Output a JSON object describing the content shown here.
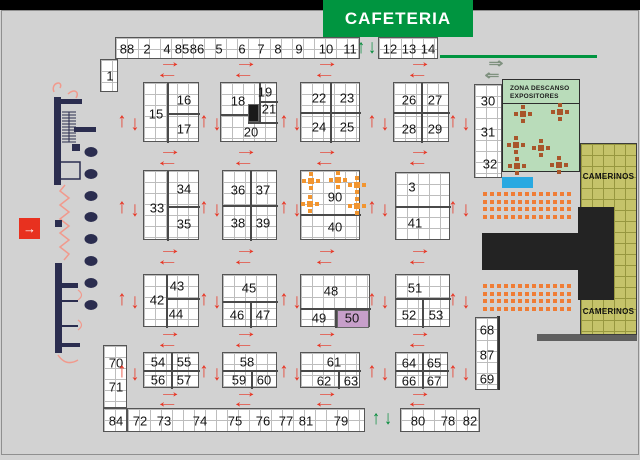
{
  "banner": {
    "cafeteria": "CAFETERIA"
  },
  "zona_descanso": {
    "line1": "ZONA DESCANSO",
    "line2": "EXPOSITORES",
    "tables": [
      {
        "x": 20,
        "y": 34
      },
      {
        "x": 57,
        "y": 32
      },
      {
        "x": 13,
        "y": 65
      },
      {
        "x": 38,
        "y": 68
      },
      {
        "x": 14,
        "y": 86
      },
      {
        "x": 56,
        "y": 85
      }
    ]
  },
  "camerinos": {
    "top": "CAMERINOS",
    "bottom": "CAMERINOS"
  },
  "entrance": {
    "glyph": "→"
  },
  "colors": {
    "bg": "#d2d2d2",
    "red_arrow": "#e8311f",
    "green_arrow": "#008a38",
    "cafeteria_green": "#009540",
    "zona_green": "#b9dcba",
    "table_brown": "#a8562b",
    "table_orange": "#f2952f",
    "seat_orange": "#f07d35",
    "olive": "#c5c36a",
    "olive_line": "#97973f",
    "purple_booth": "#c79fca",
    "navy": "#2b2d4f",
    "salmon": "#f19a8d",
    "pool_blue": "#29a9e1",
    "stage_black": "#232323"
  },
  "strips": [
    {
      "name": "top-main",
      "x": 115,
      "y": 37,
      "w": 245,
      "h": 22,
      "labels": [
        {
          "t": "88",
          "cx": 11
        },
        {
          "t": "2",
          "cx": 31
        },
        {
          "t": "4",
          "cx": 51
        },
        {
          "t": "85",
          "cx": 66
        },
        {
          "t": "86",
          "cx": 81
        },
        {
          "t": "5",
          "cx": 103
        },
        {
          "t": "6",
          "cx": 126
        },
        {
          "t": "7",
          "cx": 145
        },
        {
          "t": "8",
          "cx": 162
        },
        {
          "t": "9",
          "cx": 183
        },
        {
          "t": "10",
          "cx": 210
        },
        {
          "t": "11",
          "cx": 234
        }
      ]
    },
    {
      "name": "top-right",
      "x": 378,
      "y": 37,
      "w": 60,
      "h": 22,
      "labels": [
        {
          "t": "12",
          "cx": 11
        },
        {
          "t": "13",
          "cx": 30
        },
        {
          "t": "14",
          "cx": 49
        }
      ]
    },
    {
      "name": "booth-1",
      "x": 100,
      "y": 59,
      "w": 18,
      "h": 33,
      "labels": [
        {
          "t": "1",
          "cx": 9,
          "cy": 16
        }
      ]
    },
    {
      "name": "right-30",
      "x": 474,
      "y": 84,
      "w": 28,
      "h": 94,
      "labels": [
        {
          "t": "30",
          "cx": 13,
          "cy": 16
        },
        {
          "t": "31",
          "cx": 13,
          "cy": 47
        },
        {
          "t": "32",
          "cx": 15,
          "cy": 79
        }
      ]
    },
    {
      "name": "right-68",
      "x": 475,
      "y": 317,
      "w": 23,
      "h": 73,
      "labels": [
        {
          "t": "68",
          "cx": 11,
          "cy": 12
        },
        {
          "t": "87",
          "cx": 11,
          "cy": 37
        },
        {
          "t": "69",
          "cx": 11,
          "cy": 61
        }
      ]
    },
    {
      "name": "left-70",
      "x": 103,
      "y": 345,
      "w": 24,
      "h": 63,
      "labels": [
        {
          "t": "70",
          "cx": 12,
          "cy": 17
        },
        {
          "t": "71",
          "cx": 12,
          "cy": 41
        }
      ]
    },
    {
      "name": "corner-84",
      "x": 103,
      "y": 408,
      "w": 24,
      "h": 24,
      "labels": [
        {
          "t": "84",
          "cx": 12,
          "cy": 12
        }
      ]
    },
    {
      "name": "bottom-left",
      "x": 127,
      "y": 408,
      "w": 238,
      "h": 24,
      "labels": [
        {
          "t": "72",
          "cx": 12
        },
        {
          "t": "73",
          "cx": 36
        },
        {
          "t": "74",
          "cx": 72
        },
        {
          "t": "75",
          "cx": 107
        },
        {
          "t": "76",
          "cx": 135
        },
        {
          "t": "77",
          "cx": 158
        },
        {
          "t": "81",
          "cx": 178
        },
        {
          "t": "79",
          "cx": 213
        }
      ]
    },
    {
      "name": "bottom-right",
      "x": 400,
      "y": 408,
      "w": 80,
      "h": 24,
      "labels": [
        {
          "t": "80",
          "cx": 17
        },
        {
          "t": "78",
          "cx": 47
        },
        {
          "t": "82",
          "cx": 69
        }
      ]
    }
  ],
  "blocks": [
    {
      "name": "block-15",
      "x": 143,
      "y": 82,
      "w": 56,
      "h": 60,
      "labels": [
        {
          "t": "15",
          "cx": 12,
          "cy": 31
        },
        {
          "t": "16",
          "cx": 40,
          "cy": 17
        },
        {
          "t": "17",
          "cx": 40,
          "cy": 46
        }
      ],
      "dividers": [
        {
          "x": 23,
          "y": 0,
          "w": 2,
          "h": 60
        },
        {
          "x": 23,
          "y": 30,
          "w": 33,
          "h": 2
        }
      ]
    },
    {
      "name": "block-18",
      "x": 220,
      "y": 82,
      "w": 57,
      "h": 60,
      "labels": [
        {
          "t": "18",
          "cx": 17,
          "cy": 18
        },
        {
          "t": "19",
          "cx": 44,
          "cy": 9
        },
        {
          "t": "21",
          "cx": 48,
          "cy": 26
        },
        {
          "t": "20",
          "cx": 30,
          "cy": 49
        }
      ],
      "dividers": [
        {
          "x": 0,
          "y": 31,
          "w": 27,
          "h": 2
        },
        {
          "x": 38,
          "y": 0,
          "w": 2,
          "h": 40
        },
        {
          "x": 38,
          "y": 18,
          "w": 19,
          "h": 2
        },
        {
          "x": 27,
          "y": 39,
          "w": 30,
          "h": 2
        }
      ],
      "cells": [
        {
          "x": 27,
          "y": 21,
          "w": 11,
          "h": 18,
          "color": "#1a1a1a"
        }
      ]
    },
    {
      "name": "block-22",
      "x": 300,
      "y": 82,
      "w": 60,
      "h": 60,
      "labels": [
        {
          "t": "22",
          "cx": 18,
          "cy": 15
        },
        {
          "t": "23",
          "cx": 46,
          "cy": 15
        },
        {
          "t": "24",
          "cx": 18,
          "cy": 44
        },
        {
          "t": "25",
          "cx": 46,
          "cy": 44
        }
      ],
      "dividers": [
        {
          "x": 29,
          "y": 0,
          "w": 2,
          "h": 60
        },
        {
          "x": 0,
          "y": 29,
          "w": 60,
          "h": 2
        }
      ]
    },
    {
      "name": "block-26",
      "x": 393,
      "y": 82,
      "w": 56,
      "h": 60,
      "labels": [
        {
          "t": "26",
          "cx": 15,
          "cy": 17
        },
        {
          "t": "27",
          "cx": 41,
          "cy": 17
        },
        {
          "t": "28",
          "cx": 15,
          "cy": 46
        },
        {
          "t": "29",
          "cx": 41,
          "cy": 46
        }
      ],
      "dividers": [
        {
          "x": 27,
          "y": 0,
          "w": 2,
          "h": 60
        },
        {
          "x": 0,
          "y": 29,
          "w": 56,
          "h": 2
        }
      ]
    },
    {
      "name": "block-33",
      "x": 143,
      "y": 170,
      "w": 56,
      "h": 70,
      "labels": [
        {
          "t": "33",
          "cx": 13,
          "cy": 37
        },
        {
          "t": "34",
          "cx": 40,
          "cy": 18
        },
        {
          "t": "35",
          "cx": 40,
          "cy": 53
        }
      ],
      "dividers": [
        {
          "x": 23,
          "y": 0,
          "w": 2,
          "h": 70
        },
        {
          "x": 23,
          "y": 35,
          "w": 33,
          "h": 2
        }
      ]
    },
    {
      "name": "block-36",
      "x": 222,
      "y": 170,
      "w": 55,
      "h": 70,
      "labels": [
        {
          "t": "36",
          "cx": 15,
          "cy": 19
        },
        {
          "t": "37",
          "cx": 40,
          "cy": 19
        },
        {
          "t": "38",
          "cx": 15,
          "cy": 52
        },
        {
          "t": "39",
          "cx": 40,
          "cy": 52
        }
      ],
      "dividers": [
        {
          "x": 27,
          "y": 0,
          "w": 2,
          "h": 70
        },
        {
          "x": 0,
          "y": 34,
          "w": 55,
          "h": 2
        }
      ]
    },
    {
      "name": "block-90",
      "x": 300,
      "y": 170,
      "w": 60,
      "h": 70,
      "labels": [
        {
          "t": "90",
          "cx": 34,
          "cy": 26
        },
        {
          "t": "40",
          "cx": 34,
          "cy": 56
        }
      ],
      "dividers": [
        {
          "x": 0,
          "y": 43,
          "w": 60,
          "h": 2
        }
      ],
      "tables": [
        {
          "x": 10,
          "y": 10
        },
        {
          "x": 37,
          "y": 9
        },
        {
          "x": 56,
          "y": 14
        },
        {
          "x": 9,
          "y": 33
        },
        {
          "x": 56,
          "y": 35
        }
      ]
    },
    {
      "name": "block-3",
      "x": 395,
      "y": 172,
      "w": 55,
      "h": 68,
      "labels": [
        {
          "t": "3",
          "cx": 16,
          "cy": 14
        },
        {
          "t": "41",
          "cx": 19,
          "cy": 50
        }
      ],
      "dividers": [
        {
          "x": 0,
          "y": 33,
          "w": 55,
          "h": 2
        }
      ]
    },
    {
      "name": "block-42",
      "x": 143,
      "y": 274,
      "w": 56,
      "h": 53,
      "labels": [
        {
          "t": "42",
          "cx": 13,
          "cy": 25
        },
        {
          "t": "43",
          "cx": 33,
          "cy": 11
        },
        {
          "t": "44",
          "cx": 32,
          "cy": 39
        }
      ],
      "dividers": [
        {
          "x": 22,
          "y": 0,
          "w": 2,
          "h": 53
        },
        {
          "x": 22,
          "y": 23,
          "w": 34,
          "h": 2
        }
      ]
    },
    {
      "name": "block-45",
      "x": 222,
      "y": 274,
      "w": 55,
      "h": 53,
      "labels": [
        {
          "t": "45",
          "cx": 26,
          "cy": 13
        },
        {
          "t": "46",
          "cx": 14,
          "cy": 40
        },
        {
          "t": "47",
          "cx": 40,
          "cy": 40
        }
      ],
      "dividers": [
        {
          "x": 0,
          "y": 26,
          "w": 55,
          "h": 2
        },
        {
          "x": 27,
          "y": 26,
          "w": 2,
          "h": 27
        }
      ]
    },
    {
      "name": "block-48",
      "x": 300,
      "y": 274,
      "w": 70,
      "h": 53,
      "labels": [
        {
          "t": "48",
          "cx": 30,
          "cy": 16
        },
        {
          "t": "49",
          "cx": 18,
          "cy": 43
        },
        {
          "t": "50",
          "cx": 51,
          "cy": 43
        }
      ],
      "dividers": [
        {
          "x": 0,
          "y": 33,
          "w": 70,
          "h": 2
        },
        {
          "x": 34,
          "y": 33,
          "w": 2,
          "h": 20
        }
      ],
      "cells": [
        {
          "x": 36,
          "y": 35,
          "w": 32,
          "h": 18,
          "color": "#c79fca"
        }
      ]
    },
    {
      "name": "block-51",
      "x": 395,
      "y": 274,
      "w": 55,
      "h": 53,
      "labels": [
        {
          "t": "51",
          "cx": 19,
          "cy": 13
        },
        {
          "t": "52",
          "cx": 13,
          "cy": 40
        },
        {
          "t": "53",
          "cx": 40,
          "cy": 40
        }
      ],
      "dividers": [
        {
          "x": 0,
          "y": 23,
          "w": 55,
          "h": 2
        },
        {
          "x": 26,
          "y": 23,
          "w": 2,
          "h": 30
        }
      ]
    },
    {
      "name": "block-54",
      "x": 143,
      "y": 352,
      "w": 56,
      "h": 36,
      "labels": [
        {
          "t": "54",
          "cx": 14,
          "cy": 9
        },
        {
          "t": "55",
          "cx": 40,
          "cy": 9
        },
        {
          "t": "56",
          "cx": 14,
          "cy": 27
        },
        {
          "t": "57",
          "cx": 40,
          "cy": 27
        }
      ],
      "dividers": [
        {
          "x": 27,
          "y": 0,
          "w": 2,
          "h": 36
        },
        {
          "x": 0,
          "y": 17,
          "w": 56,
          "h": 2
        }
      ]
    },
    {
      "name": "block-58",
      "x": 222,
      "y": 352,
      "w": 55,
      "h": 36,
      "labels": [
        {
          "t": "58",
          "cx": 24,
          "cy": 9
        },
        {
          "t": "59",
          "cx": 16,
          "cy": 27
        },
        {
          "t": "60",
          "cx": 41,
          "cy": 27
        }
      ],
      "dividers": [
        {
          "x": 0,
          "y": 17,
          "w": 55,
          "h": 2
        },
        {
          "x": 28,
          "y": 17,
          "w": 2,
          "h": 19
        }
      ]
    },
    {
      "name": "block-61",
      "x": 300,
      "y": 352,
      "w": 60,
      "h": 36,
      "labels": [
        {
          "t": "61",
          "cx": 33,
          "cy": 9
        },
        {
          "t": "62",
          "cx": 23,
          "cy": 28
        },
        {
          "t": "63",
          "cx": 50,
          "cy": 28
        }
      ],
      "dividers": [
        {
          "x": 0,
          "y": 17,
          "w": 60,
          "h": 2
        },
        {
          "x": 37,
          "y": 17,
          "w": 2,
          "h": 19
        }
      ]
    },
    {
      "name": "block-64",
      "x": 395,
      "y": 352,
      "w": 53,
      "h": 36,
      "labels": [
        {
          "t": "64",
          "cx": 13,
          "cy": 10
        },
        {
          "t": "65",
          "cx": 38,
          "cy": 10
        },
        {
          "t": "66",
          "cx": 13,
          "cy": 28
        },
        {
          "t": "67",
          "cx": 38,
          "cy": 28
        }
      ],
      "dividers": [
        {
          "x": 26,
          "y": 0,
          "w": 2,
          "h": 36
        },
        {
          "x": 0,
          "y": 17,
          "w": 53,
          "h": 2
        }
      ]
    }
  ],
  "arrows": {
    "icons": {
      "up": "↑",
      "down": "↓",
      "left": "←",
      "right": "→",
      "dright": "⇒",
      "dleft": "⇐"
    },
    "red_vertical": {
      "cols": [
        122,
        204,
        284,
        372,
        453
      ],
      "rows": [
        120,
        206,
        298,
        370
      ]
    },
    "red_horizontal": {
      "cols": [
        170,
        246,
        327,
        420
      ],
      "gaps": [
        {
          "r": 63,
          "l": 74
        },
        {
          "r": 151,
          "l": 162
        },
        {
          "r": 250,
          "l": 261
        },
        {
          "r": 333,
          "l": 344
        },
        {
          "r": 393,
          "l": 403
        }
      ]
    },
    "green": [
      {
        "g": "up",
        "x": 361,
        "y": 48
      },
      {
        "g": "down",
        "x": 372,
        "y": 48
      },
      {
        "g": "up",
        "x": 376,
        "y": 419
      },
      {
        "g": "down",
        "x": 388,
        "y": 419
      }
    ],
    "gray": [
      {
        "g": "dright",
        "x": 496,
        "y": 63
      },
      {
        "g": "dleft",
        "x": 492,
        "y": 75
      }
    ]
  },
  "seating": {
    "blocks": [
      {
        "x": 483,
        "y": 192
      },
      {
        "x": 483,
        "y": 284
      }
    ],
    "cols": 13,
    "rows": 4,
    "size": 4,
    "pitch_x": 7,
    "pitch_y": 7.5
  }
}
